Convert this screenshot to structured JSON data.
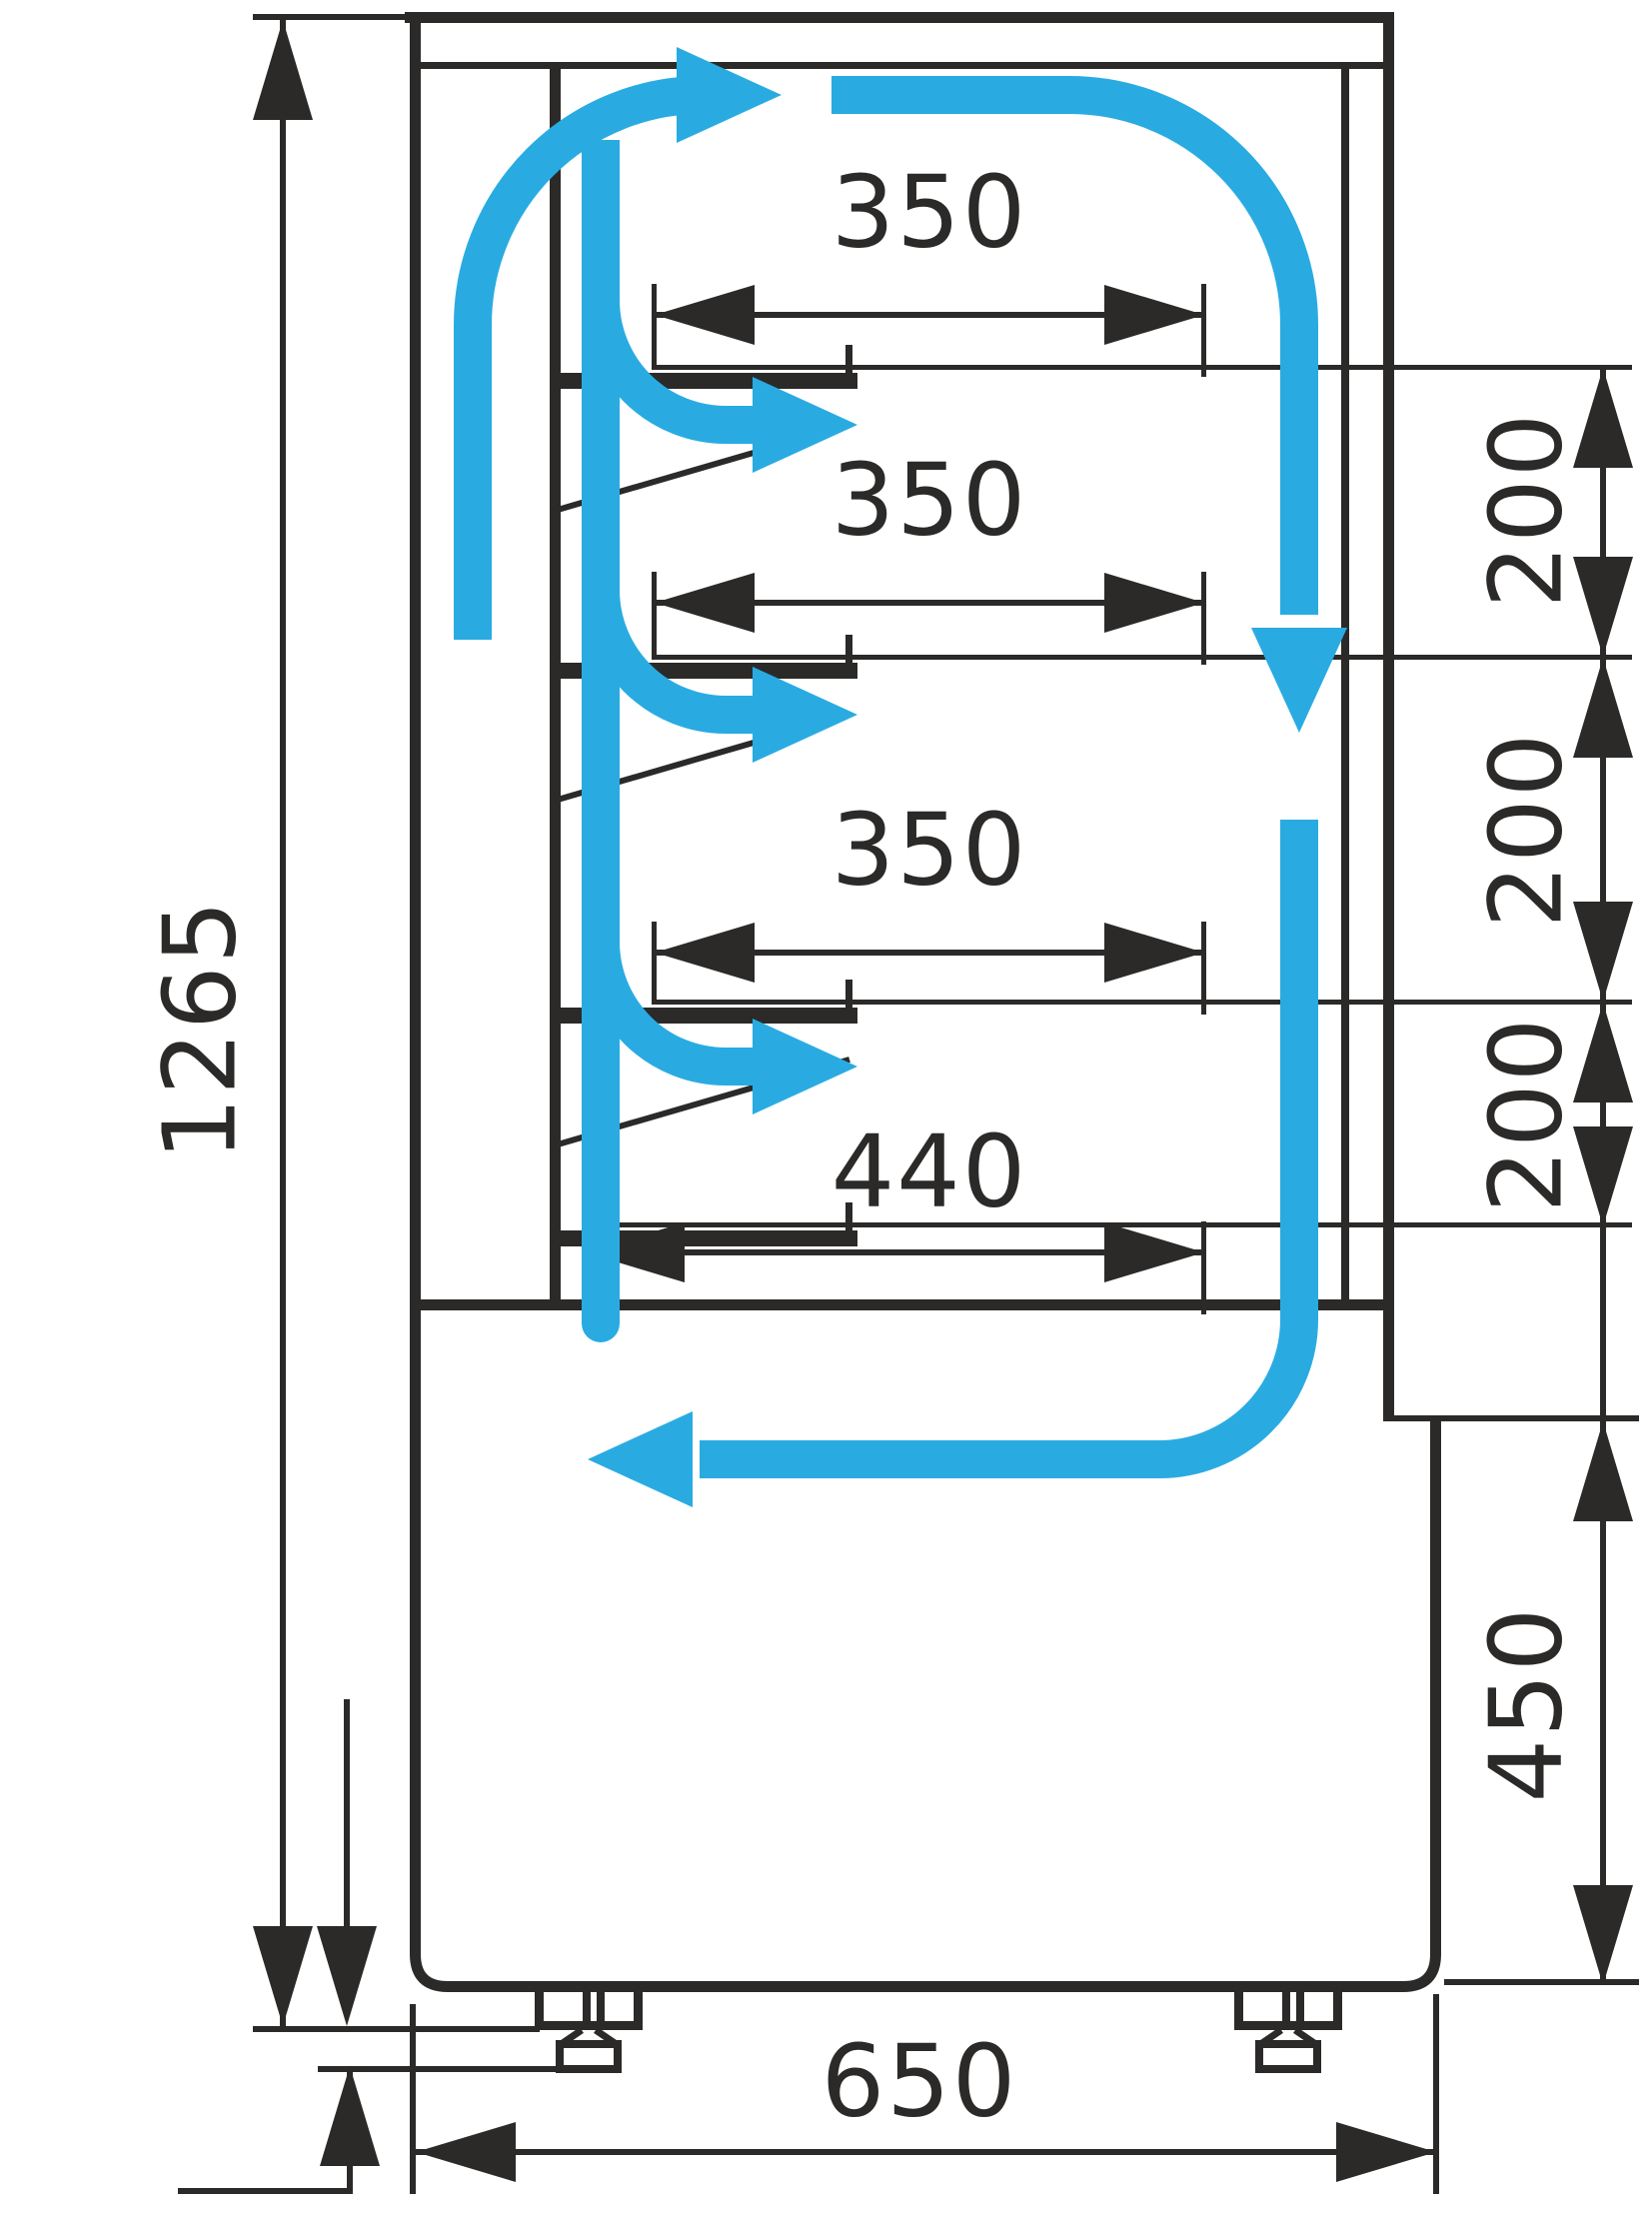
{
  "meta": {
    "title": "Refrigerated display case side cross-section with air circulation",
    "units": "mm",
    "view": "side section"
  },
  "colors": {
    "line": "#2B2A29",
    "airflow": "#29ABE2",
    "background": "#FFFFFF"
  },
  "labels": {
    "overall_height": "1265",
    "shelf_top_depth": "350",
    "shelf_mid_depth": "350",
    "shelf_low_depth": "350",
    "bottom_shelf_depth": "440",
    "shelf_gap_1": "200",
    "shelf_gap_2": "200",
    "shelf_gap_3": "200",
    "base_height": "450",
    "base_depth": "650",
    "foot_adjust_range": "20...35"
  },
  "icons": {
    "airflow_arrows": "blue flow arrows showing cold air circulation loop",
    "dimension_arrows": "black engineering dimension arrowheads"
  }
}
